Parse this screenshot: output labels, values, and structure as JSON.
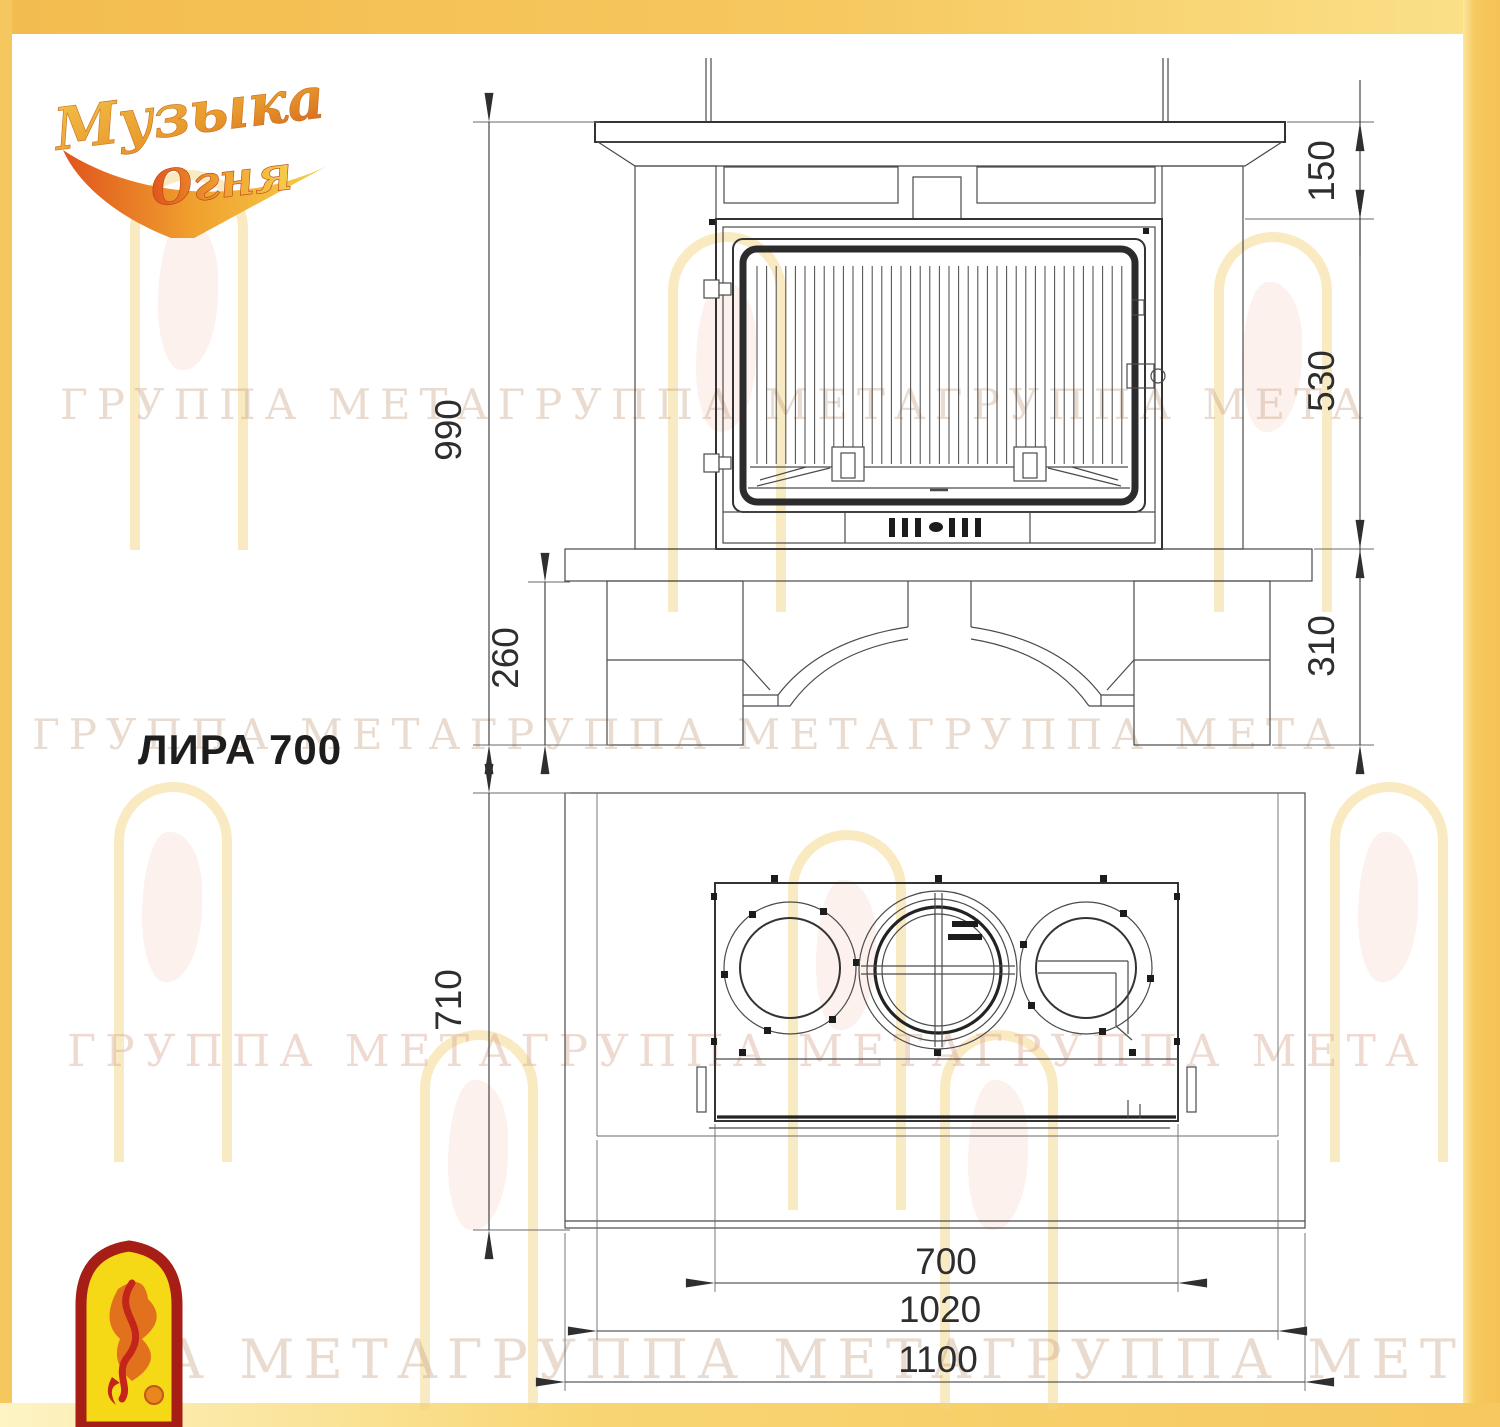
{
  "title": "ЛИРА 700",
  "brand_logo": {
    "word1": "Музыка",
    "word2": "Огня"
  },
  "watermark": {
    "rows": [
      "ГРУППА МЕТАГРУППА МЕТАГРУППА МЕТА",
      "ГРУППА МЕТАГРУППА МЕТАГРУППА МЕТА",
      "ГРУППА МЕТАГРУППА МЕТАГРУППА МЕТА",
      "ПА МЕТАГРУППА МЕТАГРУППА МЕТ"
    ]
  },
  "front_view": {
    "dims": {
      "total_height": "990",
      "base_height": "260",
      "mantel_band": "150",
      "firebox_zone": "530",
      "bench_zone": "310"
    }
  },
  "plan_view": {
    "dims": {
      "depth": "710",
      "insert_width": "700",
      "base_width": "1020",
      "overall_width": "1100"
    }
  },
  "colors": {
    "border_gold": "#f6c85f",
    "line": "#333333",
    "logo_red": "#a61e15",
    "logo_yellow": "#f6d916",
    "logo_orange": "#e07818"
  }
}
